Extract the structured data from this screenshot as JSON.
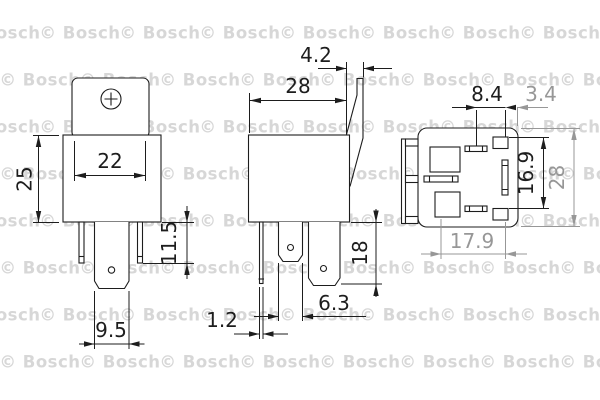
{
  "title": "Bosch relay dimensional drawing",
  "watermark": {
    "text": "© Bosch",
    "color": "#d7d7d7",
    "start_y": 33,
    "row_step": 47,
    "rows": 8,
    "col_step": 80,
    "cols": 9,
    "even_offset": 0,
    "odd_offset": 40
  },
  "colors": {
    "ink": "#1d1d1d",
    "secondary_dim": "#979797",
    "background": "#ffffff"
  },
  "dims": {
    "front": {
      "width": "22",
      "height": "25",
      "terminal_length": "11.5",
      "blade_width": "9.5"
    },
    "side": {
      "bracket_thickness": "4.2",
      "depth": "28",
      "terminal_length": "18",
      "blade_width": "6.3",
      "pin_thickness": "1.2"
    },
    "bottom": {
      "pin_offset": "8.4",
      "edge_offset": "3.4",
      "pin_pitch": "16.9",
      "height": "28",
      "pin_span": "17.9"
    }
  }
}
